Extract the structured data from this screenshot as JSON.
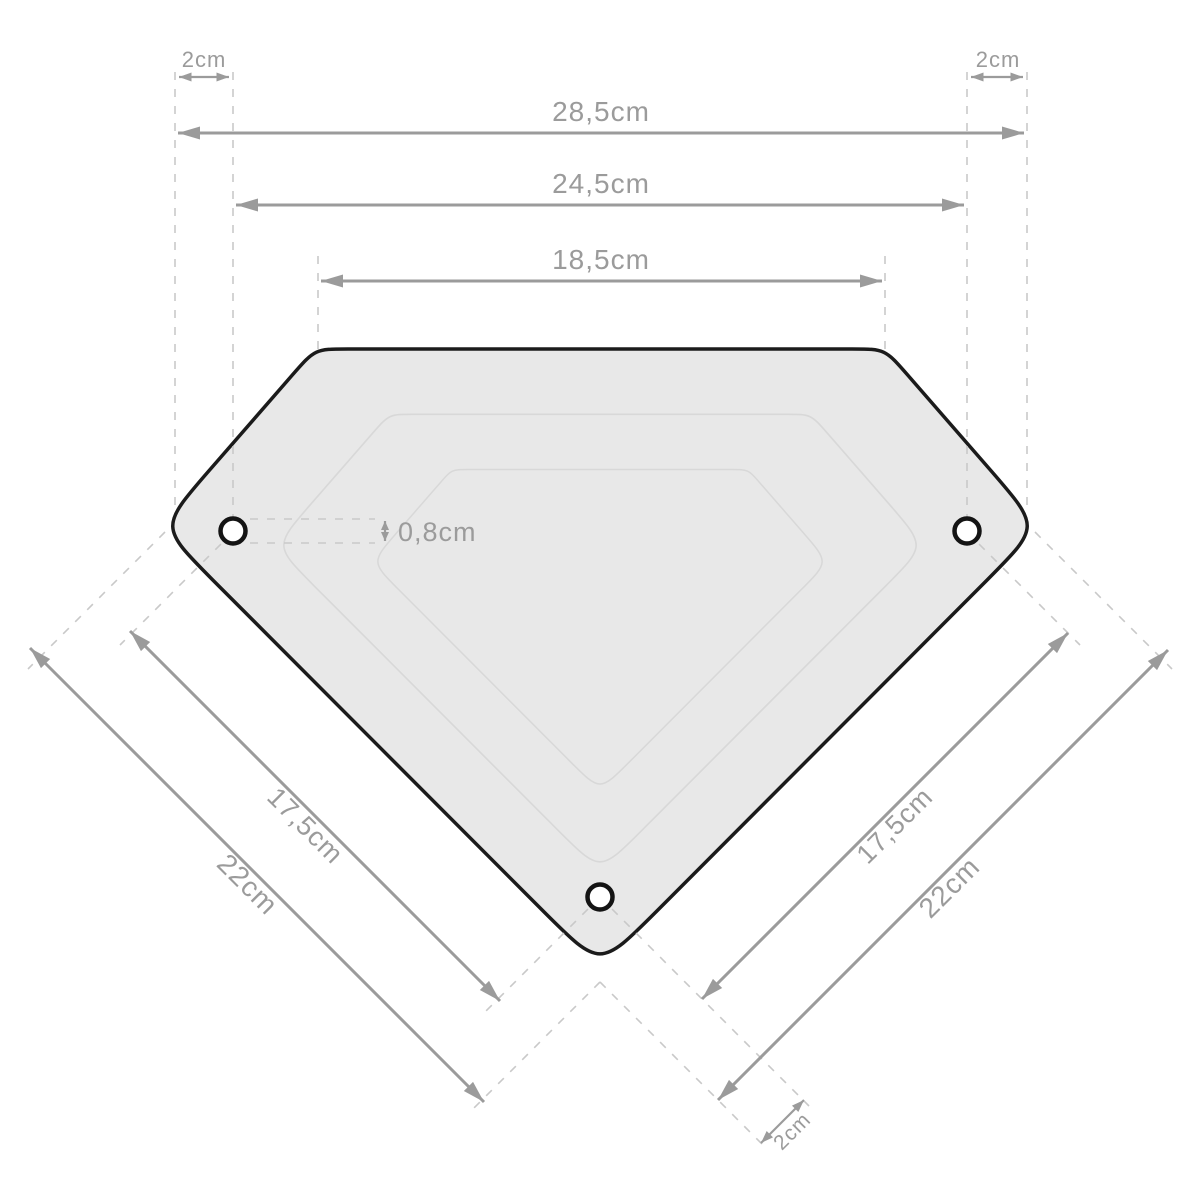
{
  "dimensions": {
    "top_offset_left": "2cm",
    "top_offset_right": "2cm",
    "overall_width": "28,5cm",
    "hole_span_width": "24,5cm",
    "top_edge_width": "18,5cm",
    "hole_diameter": "0,8cm",
    "left_hole_span": "17,5cm",
    "left_edge_length": "22cm",
    "right_hole_span": "17,5cm",
    "right_edge_length": "22cm",
    "bottom_offset": "2cm"
  },
  "colors": {
    "plate_fill": "#e8e8e8",
    "plate_outline": "#1b1b1b",
    "inner_contour": "#d8d8d8",
    "dimension_gray": "#9b9b9b",
    "dashed_gray": "#c9c9c9",
    "background": "#ffffff"
  }
}
